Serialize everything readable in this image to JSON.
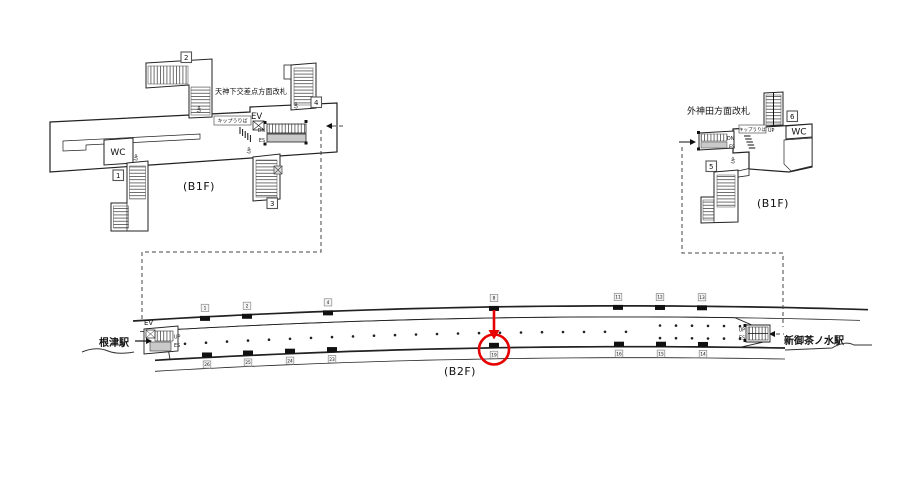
{
  "colors": {
    "highlight_red": "#e60000",
    "line_black": "#1a1a1a",
    "wall": "#222222",
    "escalator_gray": "#c9c9c9",
    "marker_box_fill": "#f4f4f4",
    "marker_box_stroke": "#8a8a8a"
  },
  "labels": {
    "up": "UP",
    "dn": "DN",
    "es": "ES",
    "ev": "EV",
    "wc": "WC",
    "ticket_office": "キップうりば"
  },
  "b1f_left": {
    "floor": "(B1F)",
    "gate": "天神下交差点方面改札",
    "exits": [
      "1",
      "2",
      "3",
      "4"
    ]
  },
  "b1f_right": {
    "floor": "(B1F)",
    "gate": "外神田方面改札",
    "exits": [
      "5",
      "6"
    ]
  },
  "b2f": {
    "floor": "(B2F)",
    "station_left": "根津駅",
    "station_right": "新御茶ノ水駅",
    "highlighted_position": "19",
    "top_positions": [
      {
        "id": "1",
        "x": 205
      },
      {
        "id": "2",
        "x": 247
      },
      {
        "id": "4",
        "x": 328
      },
      {
        "id": "8",
        "x": 494
      },
      {
        "id": "11",
        "x": 618
      },
      {
        "id": "12",
        "x": 660
      },
      {
        "id": "13",
        "x": 702
      }
    ],
    "bottom_positions": [
      {
        "id": "26",
        "x": 207
      },
      {
        "id": "25",
        "x": 248
      },
      {
        "id": "24",
        "x": 290
      },
      {
        "id": "23",
        "x": 332
      },
      {
        "id": "19",
        "x": 494,
        "highlight": true
      },
      {
        "id": "16",
        "x": 619
      },
      {
        "id": "15",
        "x": 661
      },
      {
        "id": "14",
        "x": 703
      }
    ]
  }
}
